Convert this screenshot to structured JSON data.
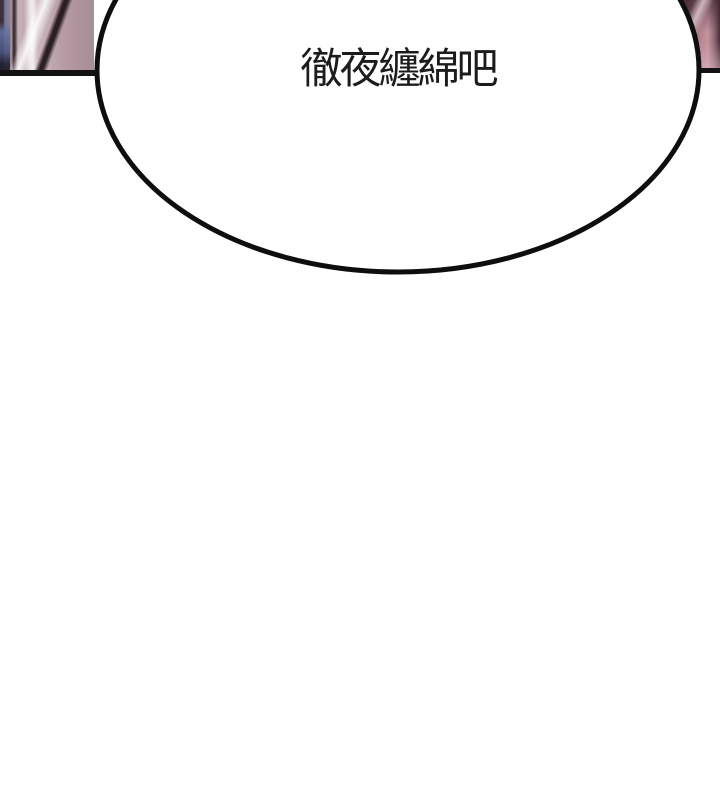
{
  "panel": {
    "kind": "webtoon-comic-panel",
    "background_color": "#ffffff",
    "border_color": "#141114"
  },
  "speech_bubble": {
    "text": "徹夜纏綿吧",
    "shape": "ellipse",
    "fill_color": "#ffffff",
    "outline_color": "#0e0e0e",
    "text_color": "#1c1c1c"
  },
  "background_art": {
    "left_sliver_colors": [
      "#41303c",
      "#70789f",
      "#a8929a",
      "#3c2f36",
      "#c6b3b9",
      "#f2ecee",
      "#b79ca6"
    ],
    "right_sliver_colors": [
      "#d3bcc3",
      "#64414d",
      "#b3848f",
      "#c493a0",
      "#4a2f38"
    ]
  }
}
